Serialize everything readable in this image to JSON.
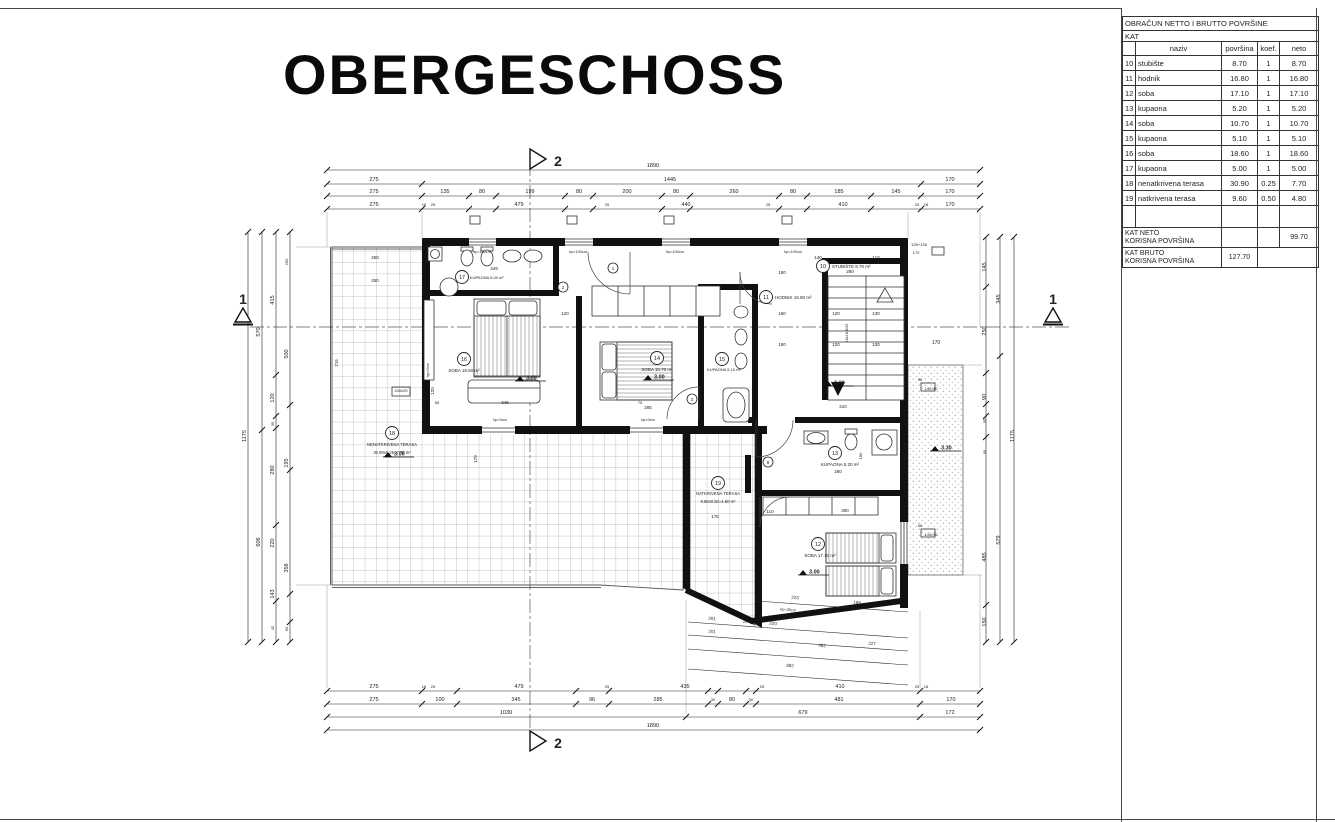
{
  "sheet": {
    "title": "OBERGESCHOSS"
  },
  "table": {
    "title": "OBRAČUN NETTO I BRUTTO POVRŠINE",
    "subtitle": "KAT",
    "headers": {
      "naziv": "naziv",
      "povrsina": "površina",
      "koef": "koef.",
      "neto": "neto"
    },
    "rows": [
      [
        "10",
        "stubište",
        "8.70",
        "1",
        "8.70"
      ],
      [
        "11",
        "hodnik",
        "16.80",
        "1",
        "16.80"
      ],
      [
        "12",
        "soba",
        "17.10",
        "1",
        "17.10"
      ],
      [
        "13",
        "kupaona",
        "5.20",
        "1",
        "5.20"
      ],
      [
        "14",
        "soba",
        "10.70",
        "1",
        "10.70"
      ],
      [
        "15",
        "kupaona",
        "5.10",
        "1",
        "5.10"
      ],
      [
        "16",
        "soba",
        "18.60",
        "1",
        "18.60"
      ],
      [
        "17",
        "kupaona",
        "5.00",
        "1",
        "5.00"
      ],
      [
        "18",
        "nenatkrivena terasa",
        "30.90",
        "0.25",
        "7.70"
      ],
      [
        "19",
        "natkrivena terasa",
        "9.60",
        "0.50",
        "4.80"
      ]
    ],
    "footer_net": {
      "label1": "KAT NETO",
      "label2": "KORISNA POVRŠINA",
      "value": "99.70"
    },
    "footer_gross": {
      "label1": "KAT BRUTO",
      "label2": "KORISNA POVRŠINA",
      "value": "127.70"
    }
  },
  "plan": {
    "labels": [
      {
        "t": "1890",
        "x": 653,
        "y": 167
      },
      {
        "t": "275",
        "x": 374,
        "y": 181
      },
      {
        "t": "1445",
        "x": 670,
        "y": 181
      },
      {
        "t": "170",
        "x": 950,
        "y": 181
      },
      {
        "t": "275",
        "x": 374,
        "y": 193
      },
      {
        "t": "135",
        "x": 445,
        "y": 193
      },
      {
        "t": "80",
        "x": 482,
        "y": 193
      },
      {
        "t": "199",
        "x": 530,
        "y": 193
      },
      {
        "t": "80",
        "x": 579,
        "y": 193
      },
      {
        "t": "200",
        "x": 627,
        "y": 193
      },
      {
        "t": "80",
        "x": 676,
        "y": 193
      },
      {
        "t": "260",
        "x": 734,
        "y": 193
      },
      {
        "t": "80",
        "x": 793,
        "y": 193
      },
      {
        "t": "185",
        "x": 839,
        "y": 193
      },
      {
        "t": "145",
        "x": 896,
        "y": 193
      },
      {
        "t": "170",
        "x": 950,
        "y": 193
      },
      {
        "t": "275",
        "x": 374,
        "y": 206
      },
      {
        "t": "18",
        "x": 424,
        "y": 206,
        "s": 4
      },
      {
        "t": "25",
        "x": 433,
        "y": 206,
        "s": 4
      },
      {
        "t": "479",
        "x": 519,
        "y": 206
      },
      {
        "t": "25",
        "x": 607,
        "y": 206,
        "s": 4
      },
      {
        "t": "440",
        "x": 686,
        "y": 206
      },
      {
        "t": "25",
        "x": 768,
        "y": 206,
        "s": 4
      },
      {
        "t": "410",
        "x": 843,
        "y": 206
      },
      {
        "t": "25",
        "x": 917,
        "y": 206,
        "s": 4
      },
      {
        "t": "18",
        "x": 926,
        "y": 206,
        "s": 4
      },
      {
        "t": "170",
        "x": 950,
        "y": 206
      },
      {
        "t": "275",
        "x": 374,
        "y": 688
      },
      {
        "t": "18",
        "x": 424,
        "y": 688,
        "s": 4
      },
      {
        "t": "25",
        "x": 433,
        "y": 688,
        "s": 4
      },
      {
        "t": "479",
        "x": 519,
        "y": 688
      },
      {
        "t": "25",
        "x": 607,
        "y": 688,
        "s": 4
      },
      {
        "t": "435",
        "x": 685,
        "y": 688
      },
      {
        "t": "25",
        "x": 762,
        "y": 688,
        "s": 4
      },
      {
        "t": "410",
        "x": 840,
        "y": 688
      },
      {
        "t": "25",
        "x": 917,
        "y": 688,
        "s": 4
      },
      {
        "t": "18",
        "x": 926,
        "y": 688,
        "s": 4
      },
      {
        "t": "275",
        "x": 374,
        "y": 701
      },
      {
        "t": "100",
        "x": 440,
        "y": 701
      },
      {
        "t": "345",
        "x": 516,
        "y": 701
      },
      {
        "t": "96",
        "x": 592,
        "y": 701
      },
      {
        "t": "285",
        "x": 658,
        "y": 701
      },
      {
        "t": "30",
        "x": 713,
        "y": 701,
        "s": 4
      },
      {
        "t": "80",
        "x": 732,
        "y": 701
      },
      {
        "t": "30",
        "x": 751,
        "y": 701,
        "s": 4
      },
      {
        "t": "481",
        "x": 839,
        "y": 701
      },
      {
        "t": "170",
        "x": 951,
        "y": 701
      },
      {
        "t": "1039",
        "x": 506,
        "y": 714
      },
      {
        "t": "679",
        "x": 803,
        "y": 714
      },
      {
        "t": "172",
        "x": 950,
        "y": 714
      },
      {
        "t": "1890",
        "x": 653,
        "y": 727
      },
      {
        "t": "2",
        "x": 558,
        "y": 166,
        "s": 14,
        "b": 1
      },
      {
        "t": "2",
        "x": 558,
        "y": 748,
        "s": 14,
        "b": 1
      },
      {
        "t": "1",
        "x": 243,
        "y": 304,
        "s": 14,
        "b": 1
      },
      {
        "t": "1",
        "x": 1053,
        "y": 304,
        "s": 14,
        "b": 1
      },
      {
        "t": "1175",
        "x": 246,
        "y": 436,
        "r": -90
      },
      {
        "t": "570",
        "x": 260,
        "y": 332,
        "r": -90
      },
      {
        "t": "606",
        "x": 260,
        "y": 542,
        "r": -90
      },
      {
        "t": "415",
        "x": 274,
        "y": 300,
        "r": -90
      },
      {
        "t": "120",
        "x": 274,
        "y": 398,
        "r": -90
      },
      {
        "t": "35",
        "x": 274,
        "y": 424,
        "r": -90,
        "s": 4
      },
      {
        "t": "280",
        "x": 274,
        "y": 470,
        "r": -90
      },
      {
        "t": "220",
        "x": 274,
        "y": 543,
        "r": -90
      },
      {
        "t": "143",
        "x": 274,
        "y": 594,
        "r": -90
      },
      {
        "t": "42",
        "x": 274,
        "y": 628,
        "r": -90,
        "s": 4
      },
      {
        "t": "250",
        "x": 288,
        "y": 262,
        "r": -90,
        "s": 4
      },
      {
        "t": "500",
        "x": 288,
        "y": 354,
        "r": -90
      },
      {
        "t": "195",
        "x": 288,
        "y": 463,
        "r": -90
      },
      {
        "t": "358",
        "x": 288,
        "y": 568,
        "r": -90
      },
      {
        "t": "60",
        "x": 288,
        "y": 629,
        "r": -90,
        "s": 4
      },
      {
        "t": "145",
        "x": 986,
        "y": 267,
        "r": -90
      },
      {
        "t": "250",
        "x": 986,
        "y": 331,
        "r": -90
      },
      {
        "t": "90",
        "x": 986,
        "y": 397,
        "r": -90
      },
      {
        "t": "35",
        "x": 986,
        "y": 421,
        "r": -90,
        "s": 4
      },
      {
        "t": "60",
        "x": 986,
        "y": 452,
        "r": -90,
        "s": 4
      },
      {
        "t": "485",
        "x": 986,
        "y": 557,
        "r": -90
      },
      {
        "t": "150",
        "x": 986,
        "y": 622,
        "r": -90
      },
      {
        "t": "345",
        "x": 1000,
        "y": 299,
        "r": -90
      },
      {
        "t": "579",
        "x": 1000,
        "y": 540,
        "r": -90
      },
      {
        "t": "1175",
        "x": 1014,
        "y": 436,
        "r": -90
      },
      {
        "t": "170",
        "x": 936,
        "y": 344,
        "s": 5
      },
      {
        "t": "135+135",
        "x": 919,
        "y": 246,
        "s": 4
      },
      {
        "t": "170",
        "x": 916,
        "y": 254,
        "s": 4
      },
      {
        "t": "349",
        "x": 494,
        "y": 270,
        "s": 4.5
      },
      {
        "t": "250",
        "x": 375,
        "y": 259,
        "s": 4.5
      },
      {
        "t": "250",
        "x": 375,
        "y": 282,
        "s": 4.5
      },
      {
        "t": "715",
        "x": 338,
        "y": 363,
        "r": -90,
        "s": 4.5
      },
      {
        "t": "120",
        "x": 434,
        "y": 391,
        "r": -90,
        "s": 4.5
      },
      {
        "t": "hp=0cm",
        "x": 429,
        "y": 370,
        "r": -90,
        "s": 3.8
      },
      {
        "t": "240x20",
        "x": 401,
        "y": 392,
        "s": 4
      },
      {
        "t": "hp=100cm",
        "x": 482,
        "y": 253,
        "s": 3.8
      },
      {
        "t": "hp=100cm",
        "x": 578,
        "y": 253,
        "s": 3.8
      },
      {
        "t": "hp=100cm",
        "x": 675,
        "y": 253,
        "s": 3.8
      },
      {
        "t": "hp=100cm",
        "x": 793,
        "y": 253,
        "s": 3.8
      },
      {
        "t": "hp=0cm",
        "x": 500,
        "y": 421,
        "s": 3.8
      },
      {
        "t": "hp=0cm",
        "x": 648,
        "y": 421,
        "s": 3.8
      },
      {
        "t": "hp=0cm",
        "x": 886,
        "y": 421,
        "s": 3.8
      },
      {
        "t": "345",
        "x": 505,
        "y": 404,
        "s": 4.5
      },
      {
        "t": "65",
        "x": 437,
        "y": 404,
        "s": 4
      },
      {
        "t": "70",
        "x": 640,
        "y": 404,
        "s": 4
      },
      {
        "t": "120",
        "x": 565,
        "y": 315,
        "s": 4.5
      },
      {
        "t": "285",
        "x": 648,
        "y": 409,
        "s": 4.5
      },
      {
        "t": "140",
        "x": 818,
        "y": 259,
        "s": 4.5
      },
      {
        "t": "110",
        "x": 876,
        "y": 259,
        "s": 4.5
      },
      {
        "t": "280",
        "x": 850,
        "y": 273,
        "s": 4.5
      },
      {
        "t": "160",
        "x": 782,
        "y": 274,
        "s": 4.5
      },
      {
        "t": "160",
        "x": 782,
        "y": 315,
        "s": 4.5
      },
      {
        "t": "160",
        "x": 782,
        "y": 346,
        "s": 4.5
      },
      {
        "t": "120",
        "x": 836,
        "y": 315,
        "s": 4.5
      },
      {
        "t": "130",
        "x": 876,
        "y": 315,
        "s": 4.5
      },
      {
        "t": "120",
        "x": 836,
        "y": 346,
        "s": 4.5
      },
      {
        "t": "130",
        "x": 876,
        "y": 346,
        "s": 4.5
      },
      {
        "t": "16x18.8/25",
        "x": 848,
        "y": 333,
        "r": -90,
        "s": 3.8
      },
      {
        "t": "310",
        "x": 843,
        "y": 408,
        "s": 4.5
      },
      {
        "t": "110",
        "x": 770,
        "y": 513,
        "s": 4.5
      },
      {
        "t": "300",
        "x": 845,
        "y": 512,
        "s": 4.5
      },
      {
        "t": "280",
        "x": 838,
        "y": 473,
        "s": 4.5
      },
      {
        "t": "180",
        "x": 862,
        "y": 456,
        "r": -90,
        "s": 4
      },
      {
        "t": "110",
        "x": 757,
        "y": 469,
        "r": -90,
        "s": 4
      },
      {
        "t": "98",
        "x": 920,
        "y": 381,
        "s": 3.8
      },
      {
        "t": "140+20",
        "x": 931,
        "y": 390,
        "s": 3.8
      },
      {
        "t": "68",
        "x": 920,
        "y": 527,
        "s": 3.8
      },
      {
        "t": "140+20",
        "x": 931,
        "y": 536,
        "s": 3.8
      },
      {
        "t": "179",
        "x": 477,
        "y": 459,
        "r": -90,
        "s": 4.5
      },
      {
        "t": "175",
        "x": 715,
        "y": 518,
        "s": 4.5
      },
      {
        "t": "hp=100cm",
        "x": 906,
        "y": 452,
        "r": -90,
        "s": 3.8
      },
      {
        "t": "223",
        "x": 795,
        "y": 599,
        "r": 4,
        "s": 4.5
      },
      {
        "t": "189",
        "x": 857,
        "y": 604,
        "r": 4,
        "s": 4.5
      },
      {
        "t": "hp=30cm",
        "x": 788,
        "y": 611,
        "r": 4,
        "s": 3.8
      },
      {
        "t": "201",
        "x": 712,
        "y": 620,
        "r": 4,
        "s": 4.5
      },
      {
        "t": "25",
        "x": 745,
        "y": 623,
        "r": 4,
        "s": 4
      },
      {
        "t": "220",
        "x": 773,
        "y": 625,
        "r": 4,
        "s": 4.5
      },
      {
        "t": "201",
        "x": 712,
        "y": 633,
        "r": 4,
        "s": 4.5
      },
      {
        "t": "227",
        "x": 872,
        "y": 645,
        "r": 4,
        "s": 4.5
      },
      {
        "t": "482",
        "x": 822,
        "y": 647,
        "r": 4,
        "s": 4.5
      },
      {
        "t": "882",
        "x": 790,
        "y": 667,
        "r": 4,
        "s": 4.5
      }
    ],
    "rooms": [
      {
        "num": "10",
        "cx": 823,
        "cy": 266,
        "name": "STUBIŠTE 8.70 m²",
        "tx": 832,
        "ty": 268,
        "a": "start",
        "s": 4.5
      },
      {
        "num": "11",
        "cx": 766,
        "cy": 297,
        "name": "HODNIK 16.80 m²",
        "tx": 775,
        "ty": 299,
        "a": "start",
        "s": 4.5
      },
      {
        "num": "12",
        "cx": 818,
        "cy": 544,
        "name": "SOBA 17.10 m²",
        "tx": 820,
        "ty": 557,
        "s": 4.5
      },
      {
        "num": "13",
        "cx": 835,
        "cy": 453,
        "name": "KUPAONA 5.20 m²",
        "tx": 840,
        "ty": 466,
        "s": 4.5
      },
      {
        "num": "14",
        "cx": 657,
        "cy": 358,
        "name": "SOBA 10.70 m²",
        "tx": 657,
        "ty": 371,
        "s": 4.5
      },
      {
        "num": "15",
        "cx": 722,
        "cy": 359,
        "name": "KUPAONA 5.10 m²",
        "tx": 724,
        "ty": 371,
        "s": 4
      },
      {
        "num": "16",
        "cx": 464,
        "cy": 359,
        "name": "SOBA 18.60 m²",
        "tx": 464,
        "ty": 372,
        "s": 4.5
      },
      {
        "num": "17",
        "cx": 462,
        "cy": 277,
        "name": "KUPAONA 5.00 m²",
        "tx": 470,
        "ty": 279,
        "a": "start",
        "s": 4
      },
      {
        "num": "18",
        "cx": 392,
        "cy": 433,
        "name": "NENATKRIVENA TERASA",
        "l2": "30.90x0.25=7.70 m²",
        "tx": 392,
        "ty": 446,
        "s": 4.2
      },
      {
        "num": "19",
        "cx": 718,
        "cy": 483,
        "name": "NATKRIVENA TERASA",
        "l2": "9.60x0.50=4.80 m²",
        "tx": 718,
        "ty": 495,
        "s": 4.2
      }
    ],
    "elevations": [
      {
        "v": "3.00",
        "x": 520,
        "y": 381
      },
      {
        "v": "3.00",
        "x": 648,
        "y": 380
      },
      {
        "v": "3.00",
        "x": 828,
        "y": 386
      },
      {
        "v": "3.00",
        "x": 803,
        "y": 575
      },
      {
        "v": "3.00",
        "x": 388,
        "y": 457
      },
      {
        "v": "3.30",
        "x": 935,
        "y": 451
      }
    ],
    "tags": [
      {
        "n": "1",
        "x": 613,
        "y": 268
      },
      {
        "n": "2",
        "x": 563,
        "y": 287
      },
      {
        "n": "2",
        "x": 692,
        "y": 399
      },
      {
        "n": "8",
        "x": 768,
        "y": 462
      }
    ],
    "ticks": [
      {
        "xs": [
          327,
          422,
          469,
          496,
          565,
          593,
          662,
          690,
          779,
          807,
          871,
          921,
          980
        ],
        "ys": [
          196,
          209
        ]
      },
      {
        "xs": [
          327,
          422,
          921,
          980
        ],
        "ys": [
          184
        ]
      },
      {
        "xs": [
          327,
          980
        ],
        "ys": [
          170,
          730
        ]
      },
      {
        "xs": [
          327,
          422,
          457,
          576,
          609,
          708,
          718,
          746,
          756,
          920,
          980
        ],
        "ys": [
          691,
          704
        ]
      },
      {
        "xs": [
          327,
          686,
          920,
          980
        ],
        "ys": [
          717
        ]
      },
      {
        "xs": [
          248
        ],
        "ys": [
          232,
          642
        ]
      },
      {
        "xs": [
          262
        ],
        "ys": [
          232,
          430,
          642
        ]
      },
      {
        "xs": [
          276
        ],
        "ys": [
          232,
          375,
          416,
          428,
          525,
          601,
          642
        ]
      },
      {
        "xs": [
          290
        ],
        "ys": [
          232,
          405,
          470,
          594,
          622,
          642
        ]
      },
      {
        "xs": [
          986
        ],
        "ys": [
          237,
          287,
          373,
          404,
          416,
          437,
          605,
          642
        ]
      },
      {
        "xs": [
          1000
        ],
        "ys": [
          237,
          356,
          642
        ]
      },
      {
        "xs": [
          1014
        ],
        "ys": [
          237,
          642
        ]
      }
    ]
  }
}
